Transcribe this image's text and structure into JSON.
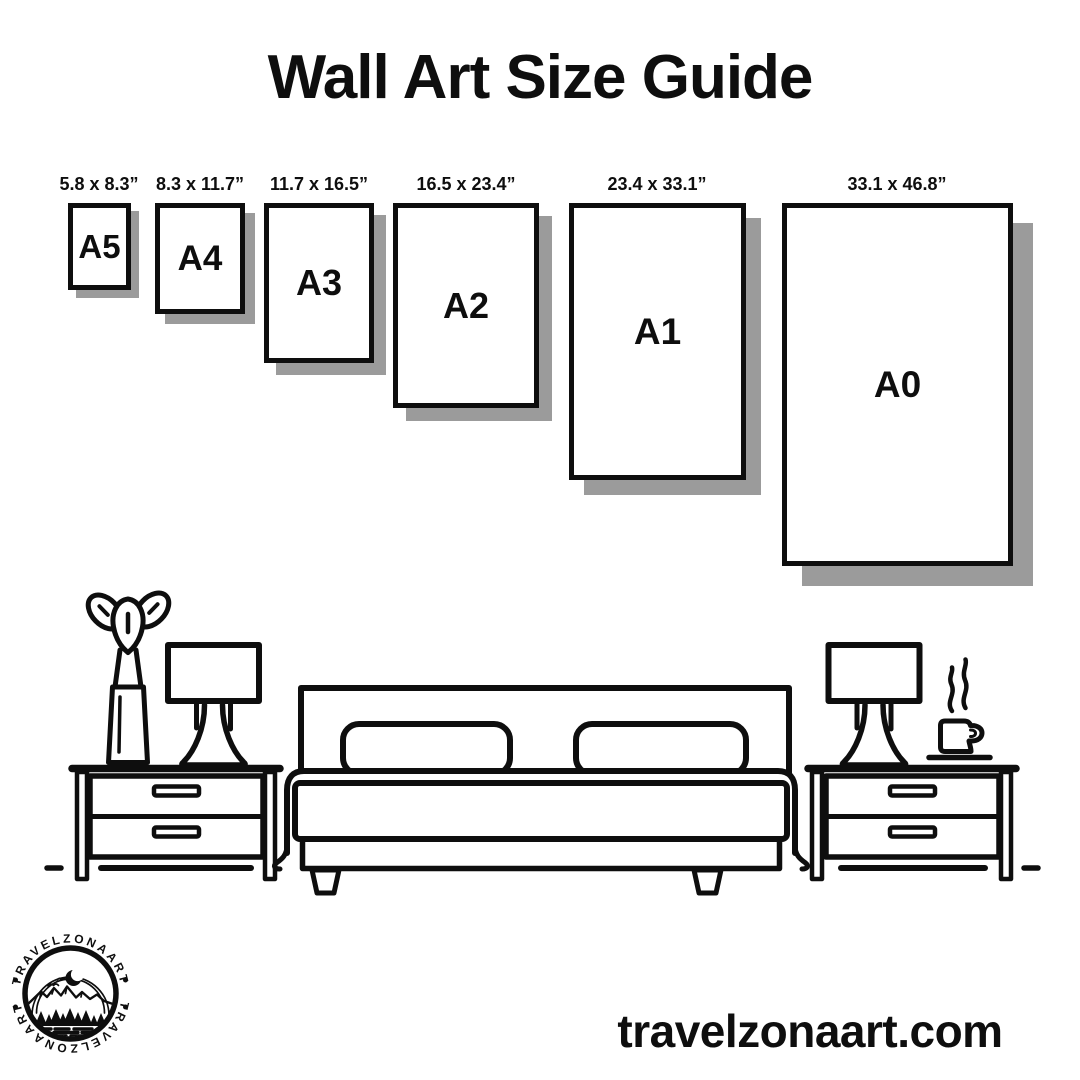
{
  "title": "Wall Art Size Guide",
  "frames": [
    {
      "code": "A5",
      "dims": "5.8 x 8.3”"
    },
    {
      "code": "A4",
      "dims": "8.3 x 11.7”"
    },
    {
      "code": "A3",
      "dims": "11.7 x 16.5”"
    },
    {
      "code": "A2",
      "dims": "16.5 x 23.4”"
    },
    {
      "code": "A1",
      "dims": "23.4 x 33.1”"
    },
    {
      "code": "A0",
      "dims": "33.1 x 46.8”"
    }
  ],
  "logo": {
    "brand_top": "TRAVELZONAART",
    "brand_bottom": "TRAVELZONAART"
  },
  "footer": {
    "website": "travelzonaart.com"
  },
  "colors": {
    "ink": "#0e0e0e",
    "shadow": "#9b9b9b",
    "background": "#ffffff"
  }
}
